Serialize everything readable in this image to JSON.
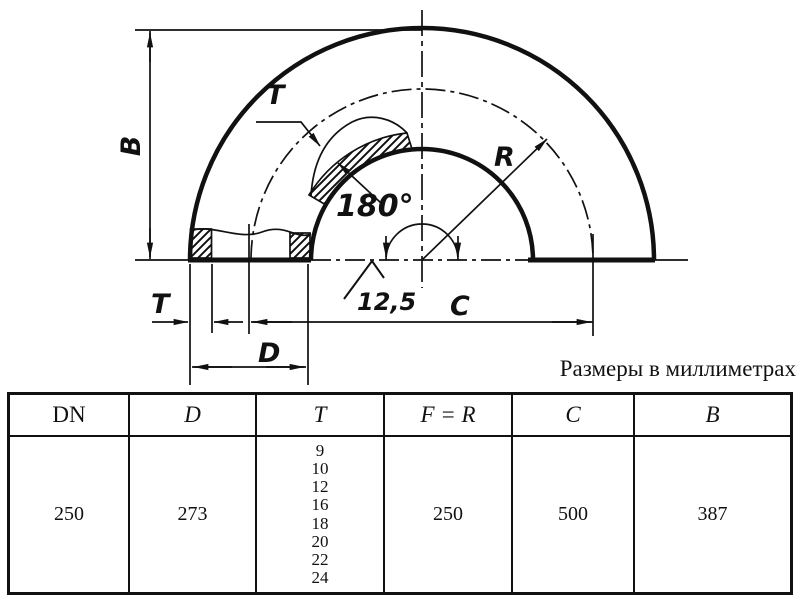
{
  "colors": {
    "ink": "#111111",
    "background": "#ffffff"
  },
  "caption": "Размеры в миллиметрах",
  "labels": {
    "B": "B",
    "T_top": "T",
    "T_bottom": "T",
    "D": "D",
    "C": "C",
    "R": "R",
    "angle": "180°",
    "roughness": "12,5"
  },
  "table": {
    "headers": [
      "DN",
      "D",
      "T",
      "F = R",
      "C",
      "B"
    ],
    "row": {
      "dn": "250",
      "d": "273",
      "t_values": [
        "9",
        "10",
        "12",
        "16",
        "18",
        "20",
        "22",
        "24"
      ],
      "f_r": "250",
      "c": "500",
      "b": "387"
    }
  }
}
